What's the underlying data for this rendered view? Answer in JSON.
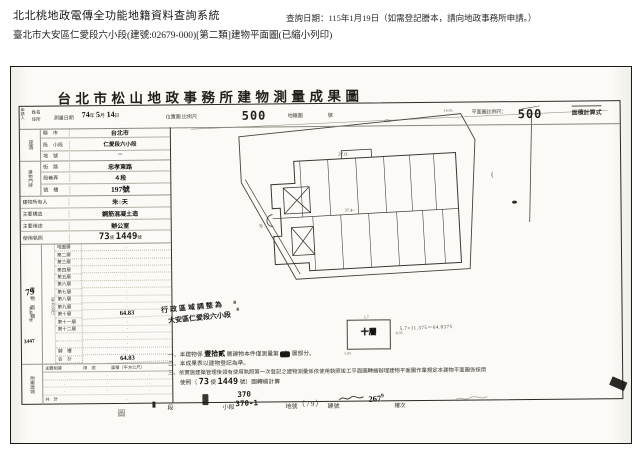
{
  "header": {
    "system_title": "北北桃地政電傳全功能地籍資料查詢系統",
    "query_date": "查詢日期：115年1月19日（如需登記謄本，請向地政事務所申請。）",
    "subject_line": "臺北市大安區仁愛段六小段(建號:02679-000)[第二類]建物平面圖(已縮小列印)"
  },
  "scan": {
    "title": "台北市松山地政事務所建物測量成果圖",
    "strip": {
      "applicant": "申請人",
      "review": "檢閱",
      "name": "姓名",
      "address": "住所",
      "survey_label": "測量日期",
      "survey_y": "74",
      "survey_y_unit": "年",
      "survey_m": "5",
      "survey_m_unit": "月",
      "survey_d": "14",
      "survey_d_unit": "日",
      "loc_label": "位置圖",
      "scale_label": "比例尺",
      "loc_scale": "500",
      "cad_label": "地籍圖",
      "no_label": "號",
      "plan_scale_label": "平面圖比例尺：",
      "plan_scale": "500",
      "formula_label": "面積計算式"
    },
    "form": {
      "seat_group": "座落",
      "doorplate_group": "建物門牌",
      "rows": [
        {
          "label": "縣　市",
          "value": "台北市"
        },
        {
          "label": "段　小段",
          "value": "仁愛段六小段"
        },
        {
          "label": "地　號",
          "value": "─"
        },
        {
          "label": "街　路",
          "value": "忠孝東路"
        },
        {
          "label": "段巷弄",
          "value": "４段"
        },
        {
          "label": "號　樓",
          "value": "197號"
        },
        {
          "label": "建物所有人",
          "value": "朱○天"
        },
        {
          "label": "主要構造",
          "value": "鋼筋混凝土造"
        },
        {
          "label": "主要用途",
          "value": "辦公室"
        }
      ],
      "permit": {
        "label": "使用執照",
        "num1": "73",
        "mid": "使",
        "num2": "1449",
        "suffix": "號"
      }
    },
    "floors": {
      "group": "建物面積",
      "unit": "（平方公尺）",
      "rows": [
        {
          "label": "地面層",
          "value": "·"
        },
        {
          "label": "第二層",
          "value": "·"
        },
        {
          "label": "第三層",
          "value": "·"
        },
        {
          "label": "第四層",
          "value": "·"
        },
        {
          "label": "第五層",
          "value": "·"
        },
        {
          "label": "第六層",
          "value": "·"
        },
        {
          "label": "第七層",
          "value": "·"
        },
        {
          "label": "第八層",
          "value": "·"
        },
        {
          "label": "第九層",
          "value": "·"
        },
        {
          "label": "第十層",
          "value": "64.83"
        },
        {
          "label": "第十一層",
          "value": "·"
        },
        {
          "label": "第十二層",
          "value": "·"
        },
        {
          "label": "",
          "value": "·"
        },
        {
          "label": "",
          "value": "·"
        },
        {
          "label": "騎　樓",
          "value": "·"
        },
        {
          "label": "合　計",
          "value": "64.83"
        }
      ]
    },
    "annex": {
      "group": "附屬建物",
      "h1": "主體相連",
      "h2": "用　途",
      "h3": "面積（平方公尺）",
      "dot": "·",
      "total_label": "共　計"
    },
    "received": {
      "hand1": "79",
      "printed": "字第　號",
      "hand2": "3447"
    },
    "handnote": {
      "line1": "行政區域調整為",
      "line2": "大安區仁愛段六小段"
    },
    "notes": {
      "n1_p1": "一、本建物係",
      "n1_hand": "壹拾貳",
      "n1_p2": "層建物本件僅測量第",
      "n1_blob": "十",
      "n1_p3": "層部分。",
      "n2": "二、本成果表以建物登記為準。",
      "n3": "三、依實施建築管理後領有使用執照第一次登記之建物測量係依使用執照竣工平面圖轉繪辦理建物平面圖作業規定本建物平面圖係採用",
      "n4_p1": "　　使照（",
      "n4_num1": "73",
      "n4_mid": "使",
      "n4_num2": "1449",
      "n4_p2": "號）圖轉繪計算"
    },
    "unit_plan": {
      "floor": "十層",
      "dim_top": "5.7",
      "dim_right": "4.05",
      "dim_bl": "1.05",
      "formula": "5.7×11.375＝64.8375"
    },
    "drawing": {
      "dim_470": "470",
      "dim_37": "37.0",
      "dim_374": "37.4~",
      "dim_1485": "14.85",
      "road": "45"
    },
    "footer": {
      "duan": "段",
      "xiaoduan": "小段",
      "v1": "370",
      "v2": "370-1",
      "dihao": "地號",
      "dihao_v": "（79）",
      "jianhao": "建號",
      "jh_v": "267",
      "jh_sup": "9",
      "louci": "樓次",
      "map": "圖"
    }
  }
}
